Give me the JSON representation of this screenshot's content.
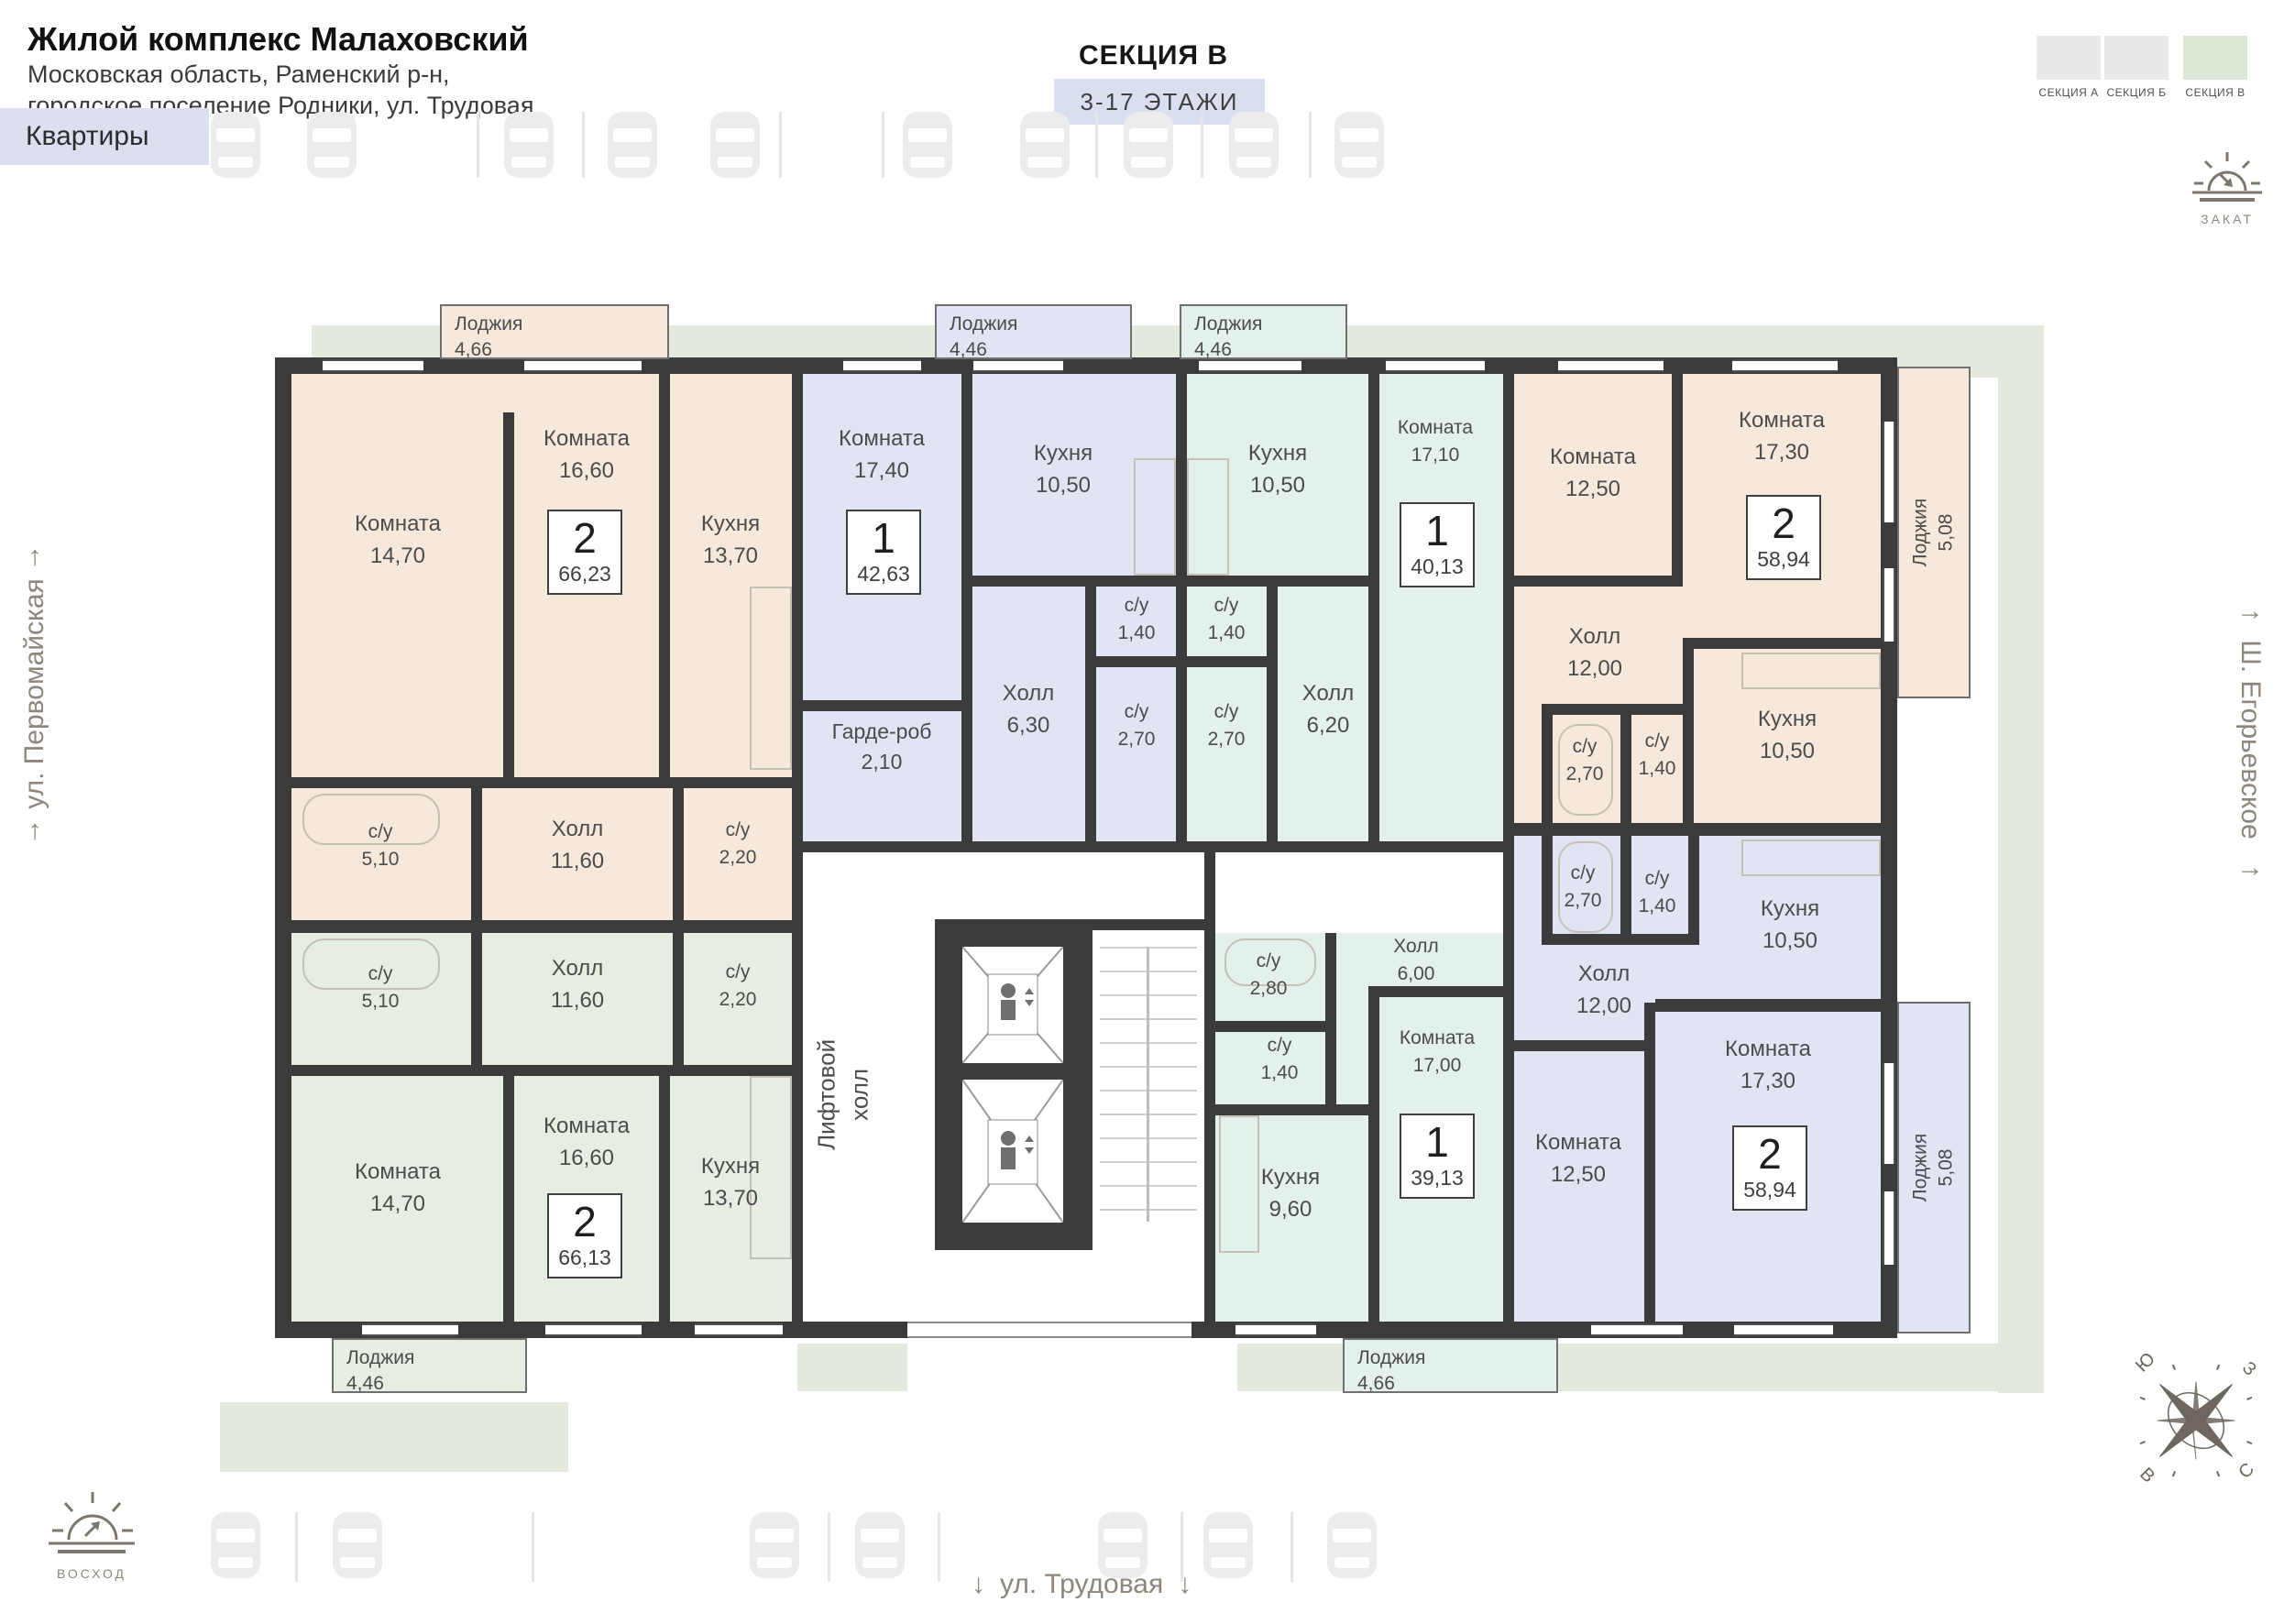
{
  "header": {
    "title": "Жилой комплекс Малаховский",
    "address_line1": "Московская область, Раменский р-н,",
    "address_line2": "городское поселение Родники, ул. Трудовая",
    "apartments_label": "Квартиры",
    "section_title": "СЕКЦИЯ В",
    "floors_label": "3-17 ЭТАЖИ"
  },
  "section_selector": {
    "items": [
      {
        "label": "СЕКЦИЯ А",
        "active": false
      },
      {
        "label": "СЕКЦИЯ Б",
        "active": false
      },
      {
        "label": "СЕКЦИЯ В",
        "active": true
      }
    ]
  },
  "orientation": {
    "sunset": "ЗАКАТ",
    "sunrise": "ВОСХОД",
    "compass": {
      "top_left": "Ю",
      "top_right": "З",
      "bottom_left": "В",
      "bottom_right": "С"
    }
  },
  "streets": {
    "left": {
      "name": "ул. Первомайская",
      "arrow": "↑"
    },
    "right": {
      "name": "Ш. Егорьевское",
      "arrow": "→"
    },
    "bottom": {
      "name": "ул. Трудовая",
      "arrow": "↓"
    }
  },
  "core": {
    "elevator_hall": "Лифтовой холл"
  },
  "apartments": [
    {
      "badge": {
        "rooms": "2",
        "area": "66,23"
      },
      "loggia": {
        "name": "Лоджия",
        "area": "4,66"
      },
      "rooms": [
        {
          "name": "Комната",
          "area": "14,70"
        },
        {
          "name": "Комната",
          "area": "16,60"
        },
        {
          "name": "Кухня",
          "area": "13,70"
        },
        {
          "name": "Холл",
          "area": "11,60"
        },
        {
          "name": "с/у",
          "area": "5,10"
        },
        {
          "name": "с/у",
          "area": "2,20"
        }
      ]
    },
    {
      "badge": {
        "rooms": "1",
        "area": "42,63"
      },
      "loggia": {
        "name": "Лоджия",
        "area": "4,46"
      },
      "rooms": [
        {
          "name": "Комната",
          "area": "17,40"
        },
        {
          "name": "Кухня",
          "area": "10,50"
        },
        {
          "name": "Холл",
          "area": "6,30"
        },
        {
          "name": "Гарде-роб",
          "area": "2,10"
        },
        {
          "name": "с/у",
          "area": "1,40"
        },
        {
          "name": "с/у",
          "area": "2,70"
        }
      ]
    },
    {
      "badge": {
        "rooms": "1",
        "area": "40,13"
      },
      "loggia": {
        "name": "Лоджия",
        "area": "4,46"
      },
      "rooms": [
        {
          "name": "Кухня",
          "area": "10,50"
        },
        {
          "name": "с/у",
          "area": "1,40"
        },
        {
          "name": "с/у",
          "area": "2,70"
        },
        {
          "name": "Холл",
          "area": "6,20"
        },
        {
          "name": "Комната",
          "area": "17,10"
        }
      ]
    },
    {
      "badge": {
        "rooms": "2",
        "area": "58,94"
      },
      "loggia": {
        "name": "Лоджия",
        "area": "5,08"
      },
      "rooms": [
        {
          "name": "Комната",
          "area": "12,50"
        },
        {
          "name": "Комната",
          "area": "17,30"
        },
        {
          "name": "Холл",
          "area": "12,00"
        },
        {
          "name": "с/у",
          "area": "2,70"
        },
        {
          "name": "с/у",
          "area": "1,40"
        },
        {
          "name": "Кухня",
          "area": "10,50"
        }
      ]
    },
    {
      "badge": {
        "rooms": "2",
        "area": "66,13"
      },
      "loggia": {
        "name": "Лоджия",
        "area": "4,46"
      },
      "rooms": [
        {
          "name": "с/у",
          "area": "5,10"
        },
        {
          "name": "Холл",
          "area": "11,60"
        },
        {
          "name": "с/у",
          "area": "2,20"
        },
        {
          "name": "Комната",
          "area": "14,70"
        },
        {
          "name": "Комната",
          "area": "16,60"
        },
        {
          "name": "Кухня",
          "area": "13,70"
        }
      ]
    },
    {
      "badge": {
        "rooms": "1",
        "area": "39,13"
      },
      "loggia": {
        "name": "Лоджия",
        "area": "4,66"
      },
      "rooms": [
        {
          "name": "с/у",
          "area": "2,80"
        },
        {
          "name": "с/у",
          "area": "1,40"
        },
        {
          "name": "Холл",
          "area": "6,00"
        },
        {
          "name": "Комната",
          "area": "17,00"
        },
        {
          "name": "Кухня",
          "area": "9,60"
        }
      ]
    },
    {
      "badge": {
        "rooms": "2",
        "area": "58,94"
      },
      "loggia": {
        "name": "Лоджия",
        "area": "5,08"
      },
      "rooms": [
        {
          "name": "с/у",
          "area": "2,70"
        },
        {
          "name": "с/у",
          "area": "1,40"
        },
        {
          "name": "Кухня",
          "area": "10,50"
        },
        {
          "name": "Холл",
          "area": "12,00"
        },
        {
          "name": "Комната",
          "area": "12,50"
        },
        {
          "name": "Комната",
          "area": "17,30"
        }
      ]
    }
  ],
  "colors": {
    "wall": "#3b3b3b",
    "beige": "#f6e8da",
    "lavender": "#e0e4f3",
    "teal": "#e3f0ec",
    "green": "#e6eee1",
    "sage": "#e4e9dd",
    "accent_chip": "#dcdff0",
    "section_active": "#dde7d8"
  }
}
